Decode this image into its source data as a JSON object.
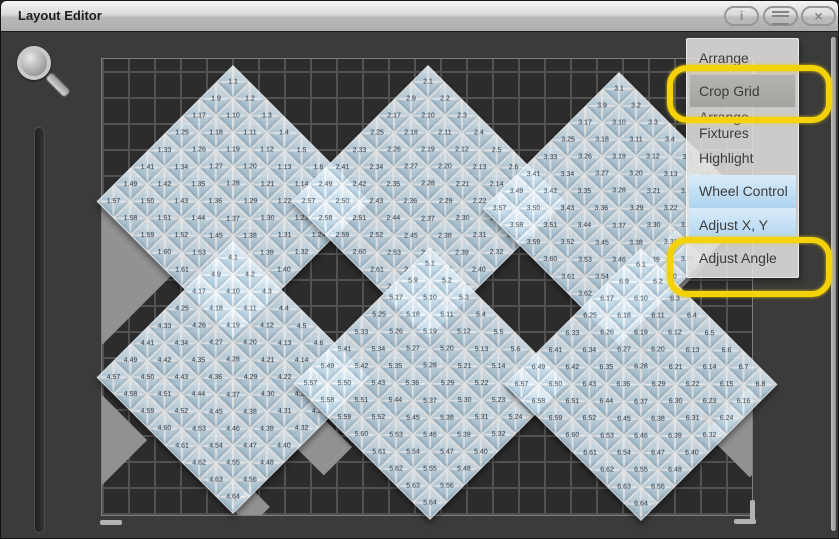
{
  "window": {
    "title": "Layout Editor",
    "buttons": [
      {
        "name": "info-button",
        "glyph": "i"
      },
      {
        "name": "menu-button",
        "glyph": "menu-icon"
      },
      {
        "name": "close-button",
        "glyph": "×"
      }
    ]
  },
  "tools": {
    "magnifier_icon": "magnifier-zoom",
    "zoom_slider": "vertical-zoom-slider"
  },
  "grid": {
    "x": 100,
    "y": 57,
    "width": 652,
    "height": 458,
    "cell_size": 26,
    "background_color": "#2c2c2c",
    "line_color": "#525252",
    "cropped_patch_color": "#919191"
  },
  "fixtures": {
    "count": 6,
    "cells_per_fixture": 64,
    "cell_grid": "8x8",
    "numbering": "row-major",
    "label_format": "{fixture}.{cell}",
    "rotation_deg": 45,
    "cluster_side_px": 193,
    "clusters": [
      {
        "prefix": "1",
        "tip_x": 232,
        "tip_y": 64
      },
      {
        "prefix": "2",
        "tip_x": 427,
        "tip_y": 64
      },
      {
        "prefix": "3",
        "tip_x": 618,
        "tip_y": 71
      },
      {
        "prefix": "4",
        "tip_x": 232,
        "tip_y": 240
      },
      {
        "prefix": "5",
        "tip_x": 429,
        "tip_y": 246
      },
      {
        "prefix": "6",
        "tip_x": 640,
        "tip_y": 247
      }
    ]
  },
  "cropped_patches": [
    {
      "cx": 100,
      "cy": 272,
      "half": 70
    },
    {
      "cx": 330,
      "cy": 200,
      "half": 39
    },
    {
      "cx": 526,
      "cy": 201,
      "half": 39
    },
    {
      "cx": 677,
      "cy": 258,
      "half": 32
    },
    {
      "cx": 748,
      "cy": 430,
      "half": 45
    },
    {
      "cx": 100,
      "cy": 438,
      "half": 45
    },
    {
      "cx": 322,
      "cy": 445,
      "half": 28
    },
    {
      "cx": 248,
      "cy": 505,
      "half": 20
    }
  ],
  "menu": {
    "items": [
      {
        "label": "Arrange",
        "state": "normal",
        "annotated": false
      },
      {
        "label": "Crop Grid",
        "state": "pressed",
        "annotated": true
      },
      {
        "label": "Arrange Fixtures",
        "state": "normal",
        "annotated": false
      },
      {
        "label": "Highlight",
        "state": "normal",
        "annotated": false
      },
      {
        "label": "Wheel Control",
        "state": "active",
        "annotated": false
      },
      {
        "label": "Adjust X, Y",
        "state": "active",
        "annotated": false
      },
      {
        "label": "Adjust Angle",
        "state": "normal",
        "annotated": true
      }
    ],
    "active_color": "#aed3ef",
    "annotation_color": "#f3d207"
  },
  "annotation_rings": [
    {
      "target": "Crop Grid",
      "x": 666,
      "y": 64,
      "w": 153,
      "h": 46
    },
    {
      "target": "Adjust Angle",
      "x": 666,
      "y": 236,
      "w": 153,
      "h": 48
    }
  ],
  "handles": [
    {
      "name": "grid-handle-bottom-left",
      "x": 99,
      "y": 519,
      "w": 22,
      "h": 5
    },
    {
      "name": "grid-handle-bottom-right-h",
      "x": 733,
      "y": 518,
      "w": 22,
      "h": 5
    },
    {
      "name": "grid-handle-bottom-right-v",
      "x": 749,
      "y": 499,
      "w": 5,
      "h": 21
    },
    {
      "name": "grid-handle-top-right-v",
      "x": 751,
      "y": 62,
      "w": 4,
      "h": 18
    }
  ]
}
